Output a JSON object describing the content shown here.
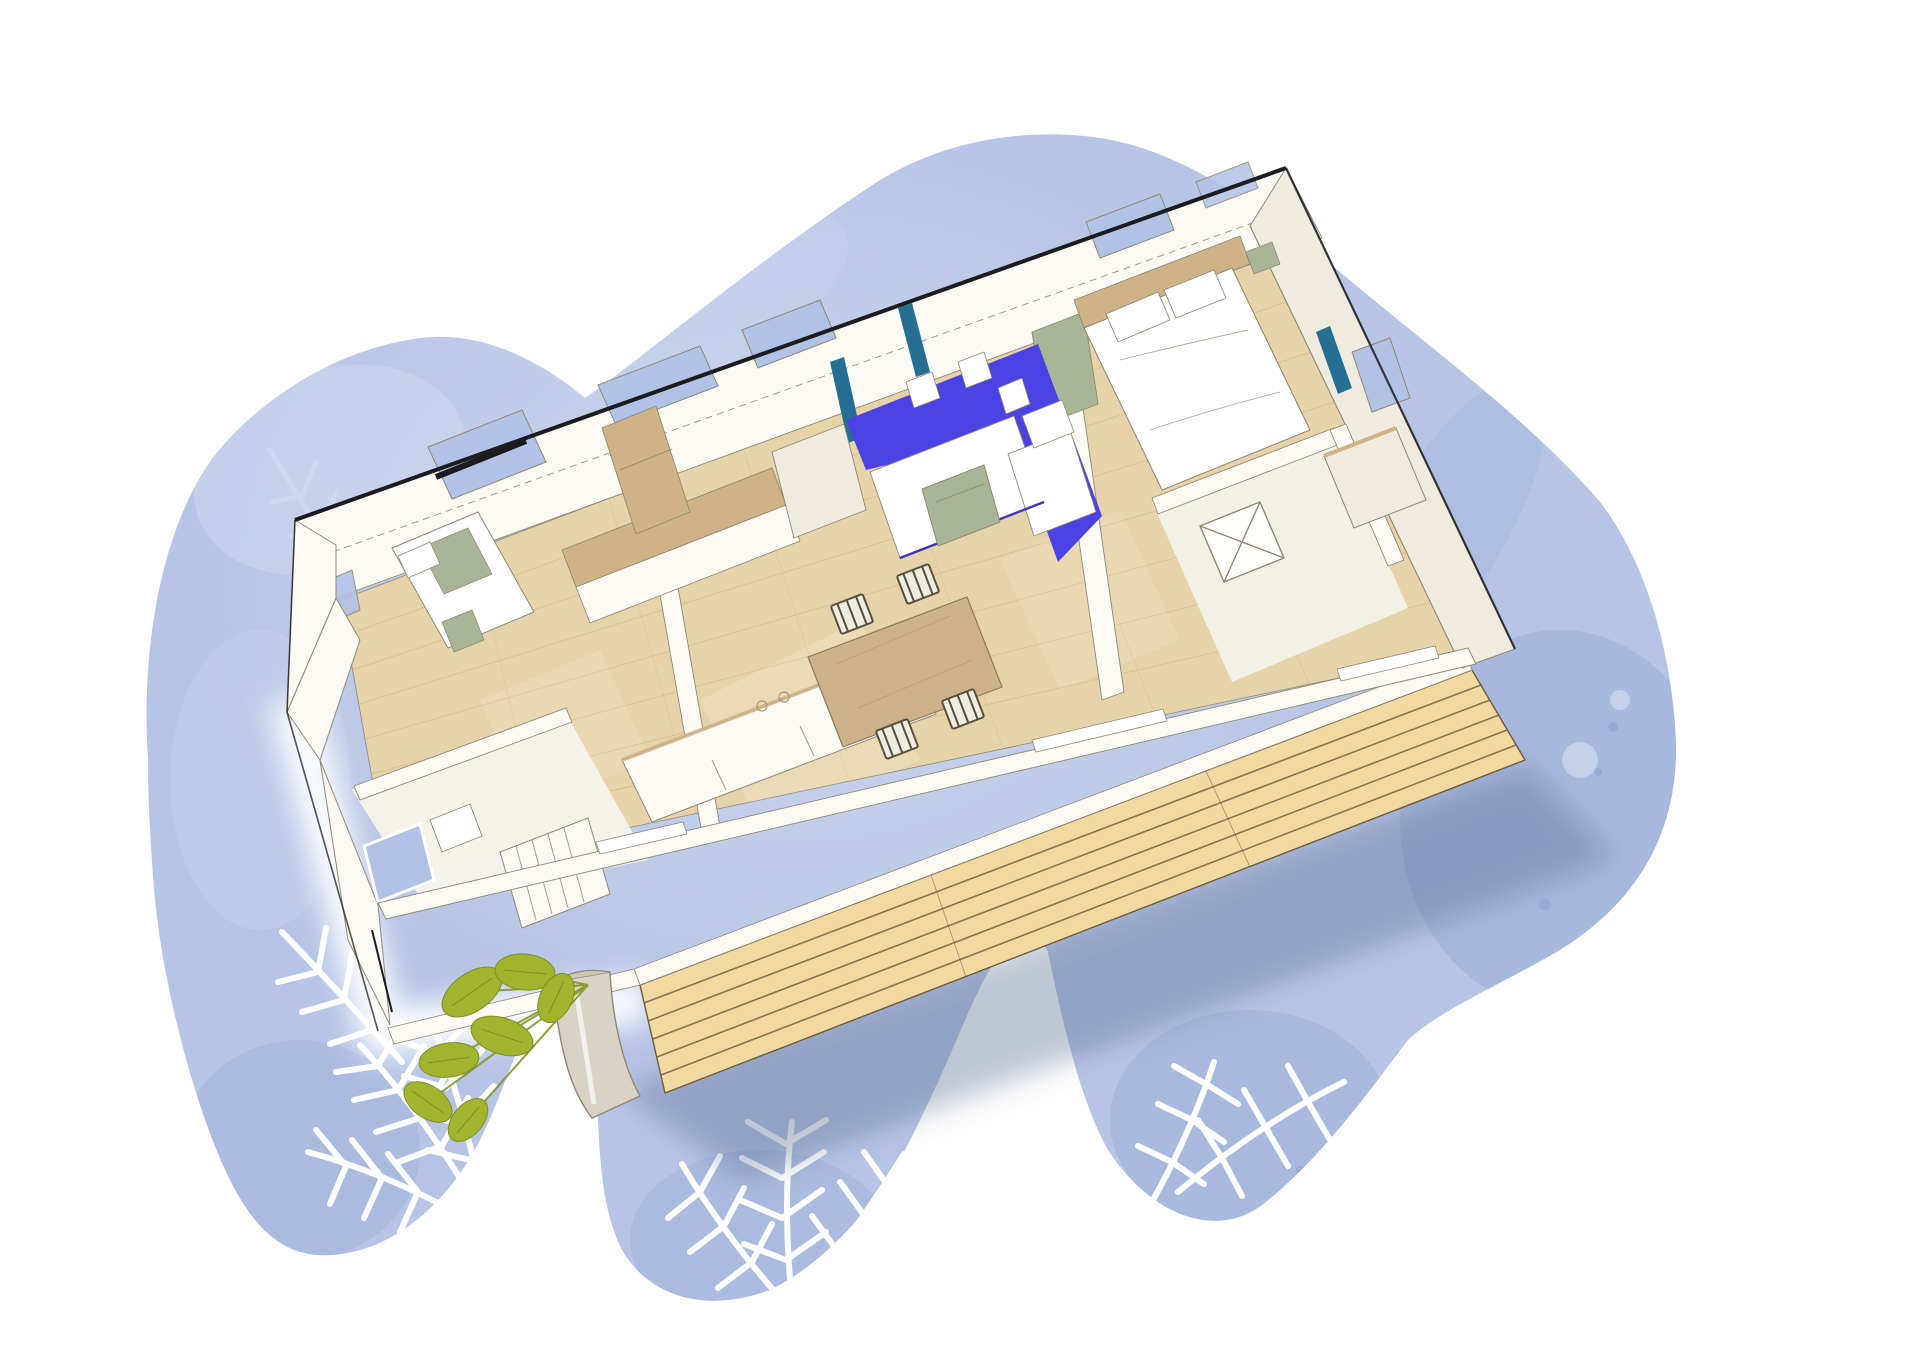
{
  "scene": {
    "subject": "3D cutaway illustration of a two-bedroom mobile home floor plan on a blue watercolor blob with white palm-frond silhouettes",
    "style": "architect watercolor sketch, aerial axonometric view, no text or labels",
    "elements": [
      {
        "name": "watercolor-blob-background",
        "color_key": "blob"
      },
      {
        "name": "palm-frond-silhouettes",
        "color_key": "paper"
      },
      {
        "name": "mobile-home-cutaway",
        "color_key": "wall"
      },
      {
        "name": "black-roof-edge",
        "color_key": "roof_edge"
      },
      {
        "name": "parquet-wood-floor",
        "color_key": "wood"
      },
      {
        "name": "wooden-deck-terrace",
        "color_key": "deck"
      },
      {
        "name": "blue-corner-sofa-with-white-cushions",
        "color_key": "sofa"
      },
      {
        "name": "dining-table-with-four-chairs",
        "color_key": "table"
      },
      {
        "name": "kitchen-counters-and-cabinets",
        "color_key": "wall"
      },
      {
        "name": "master-bed-with-pillows",
        "color_key": "cushion"
      },
      {
        "name": "second-bedroom-bed",
        "color_key": "cushion"
      },
      {
        "name": "shower-rooms",
        "color_key": "wall"
      },
      {
        "name": "teal-framed-windows",
        "color_key": "teal"
      },
      {
        "name": "sage-green-accents",
        "color_key": "sage"
      },
      {
        "name": "potted-green-plant",
        "color_key": "plant"
      },
      {
        "name": "deck-shadow",
        "color_key": "shadow"
      }
    ]
  },
  "canvas": {
    "width": 1920,
    "height": 1357
  },
  "colors": {
    "paper": "#ffffff",
    "blob": "#b6c4e5",
    "blob_light": "#cdd8ef",
    "blob_deep": "#91a7d3",
    "roof_edge": "#1c1c1e",
    "line": "#8f8874",
    "wall": "#fbfaf4",
    "wall_shade": "#efecdf",
    "wood": "#e7d3a9",
    "wood_line": "#cfb386",
    "deck": "#f2d9a2",
    "deck_line": "#6d5b3d",
    "sofa": "#4a42e2",
    "sofa_shadow": "#3a34b8",
    "teal": "#256f92",
    "sky": "#b0c2e6",
    "table": "#cdb289",
    "sage": "#a8b596",
    "plant": "#a2b32f",
    "plant_dark": "#7e8f1f",
    "pot": "#d9d3c5",
    "cushion": "#ffffff",
    "shadow": "rgba(86,104,143,0.38)"
  }
}
